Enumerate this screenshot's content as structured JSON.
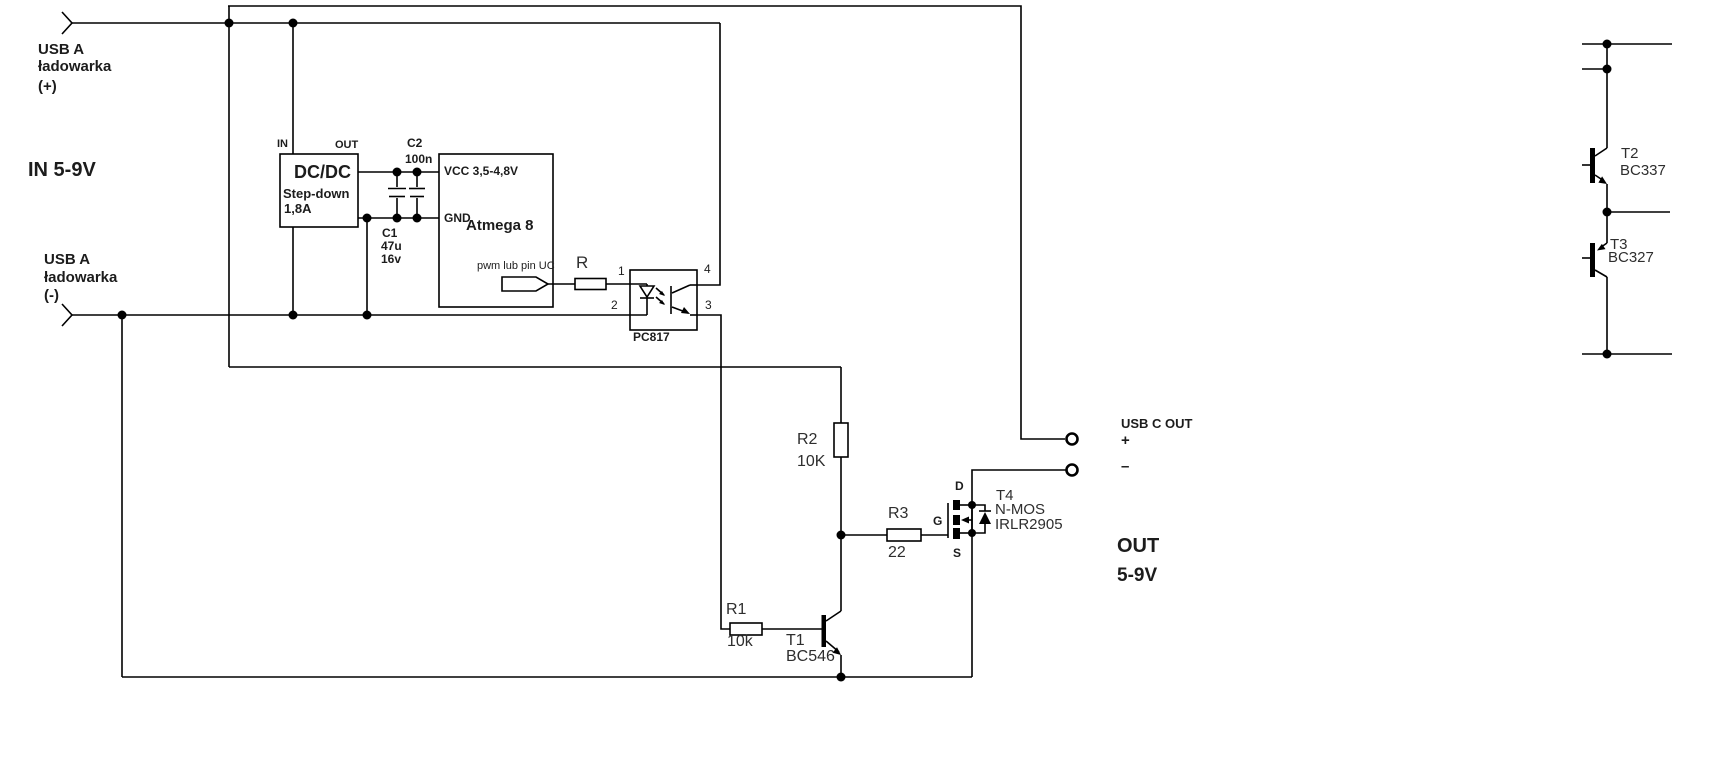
{
  "colors": {
    "wire": "#000000",
    "label": "#1c1c1c",
    "component_label": "#2e2e2e",
    "background": "#ffffff"
  },
  "input": {
    "usb_a_plus": {
      "l1": "USB A",
      "l2": "ładowarka",
      "l3": "(+)"
    },
    "usb_a_minus": {
      "l1": "USB A",
      "l2": "ładowarka",
      "l3": "(-)"
    },
    "voltage": "IN 5-9V"
  },
  "dcdc": {
    "pin_in": "IN",
    "pin_out": "OUT",
    "name": "DC/DC",
    "line2": "Step-down",
    "line3": "1,8A"
  },
  "c1": {
    "name": "C1",
    "value": "47u",
    "voltage": "16v"
  },
  "c2": {
    "name": "C2",
    "value": "100n"
  },
  "mcu": {
    "vcc": "VCC 3,5-4,8V",
    "gnd": "GND",
    "name": "Atmega 8",
    "pwm_note": "pwm lub pin UC"
  },
  "r": {
    "name": "R"
  },
  "opto": {
    "pin1": "1",
    "pin2": "2",
    "pin3": "3",
    "pin4": "4",
    "name": "PC817"
  },
  "r1": {
    "name": "R1",
    "value": "10k"
  },
  "r2": {
    "name": "R2",
    "value": "10K"
  },
  "r3": {
    "name": "R3",
    "value": "22"
  },
  "t1": {
    "name": "T1",
    "part": "BC546"
  },
  "t4": {
    "name": "T4",
    "type": "N-MOS",
    "part": "IRLR2905",
    "g": "G",
    "d": "D",
    "s": "S"
  },
  "output": {
    "title": "USB C OUT",
    "plus": "+",
    "minus": "–",
    "label": "OUT",
    "voltage": "5-9V"
  },
  "driver": {
    "t2": "T2",
    "t2_part": "BC337",
    "t3": "T3",
    "t3_part": "BC327"
  }
}
